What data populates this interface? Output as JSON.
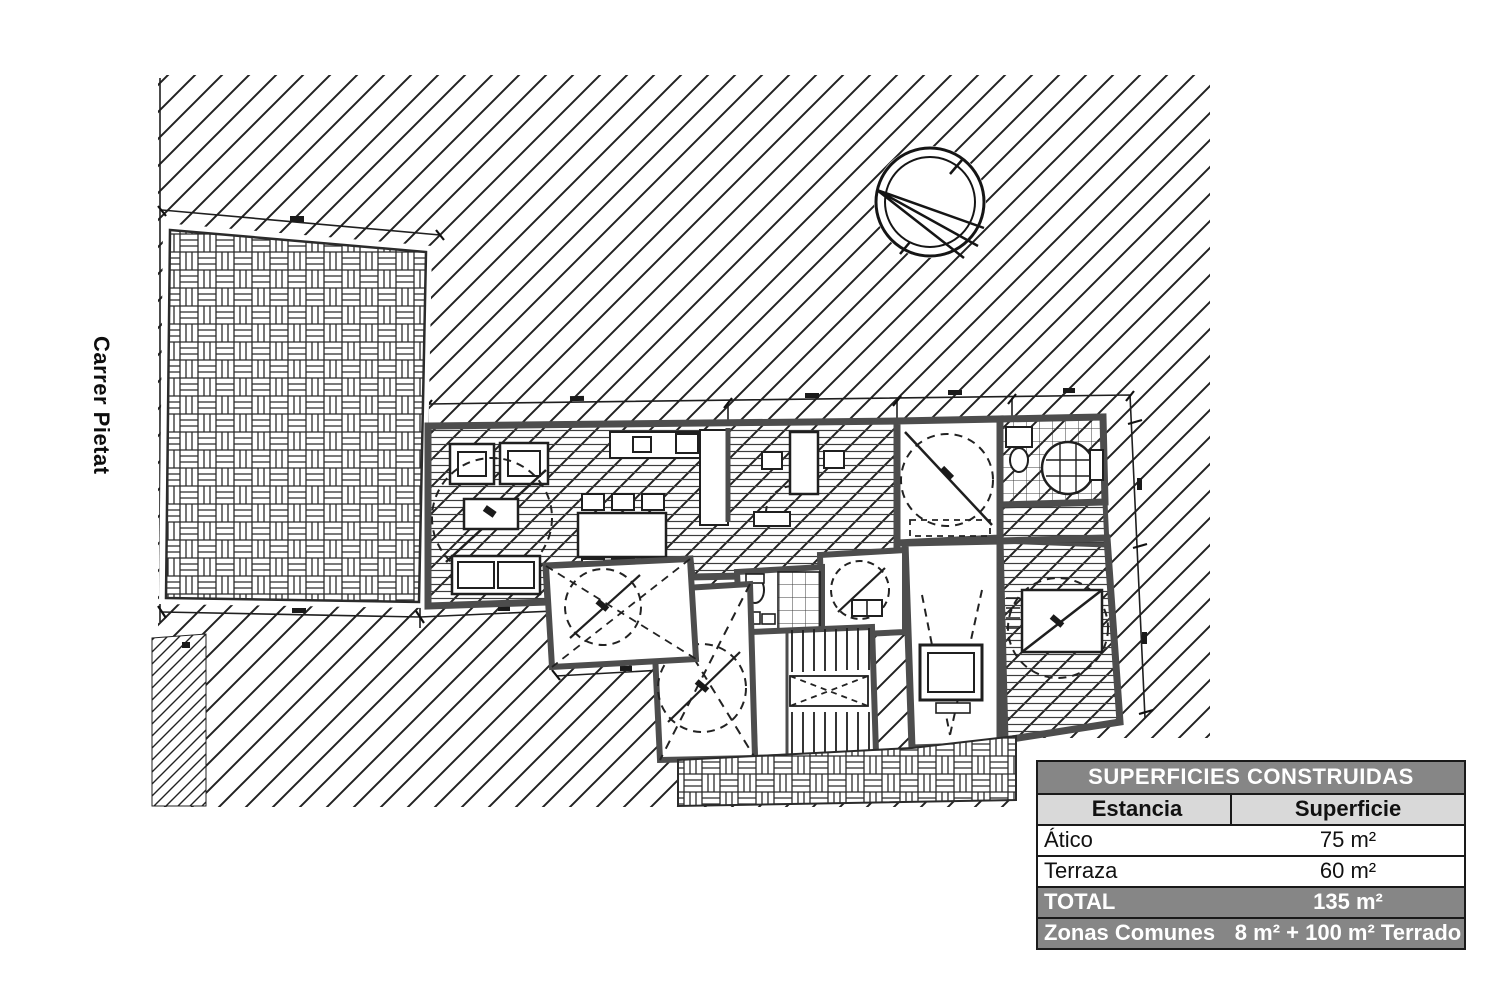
{
  "street_label": "Carrer Pietat",
  "icons": {
    "north_arrow": "compass-north-arrow",
    "site_hatch": "diagonal-hatch-ground",
    "paving": "basketweave-paving"
  },
  "areas_table": {
    "title": "SUPERFICIES CONSTRUIDAS",
    "col1": "Estancia",
    "col2": "Superficie",
    "rows": [
      {
        "name": "Ático",
        "value": "75 m²"
      },
      {
        "name": "Terraza",
        "value": "60 m²"
      },
      {
        "name": "TOTAL",
        "value": "135 m²"
      },
      {
        "name": "Zonas Comunes",
        "value": "8 m² + 100 m² Terrado"
      }
    ],
    "colors": {
      "header_bg": "#868686",
      "header_text": "#ffffff",
      "subheader_bg": "#d9d9d9",
      "row_bg": "#ffffff",
      "border": "#1a1a1a"
    }
  }
}
